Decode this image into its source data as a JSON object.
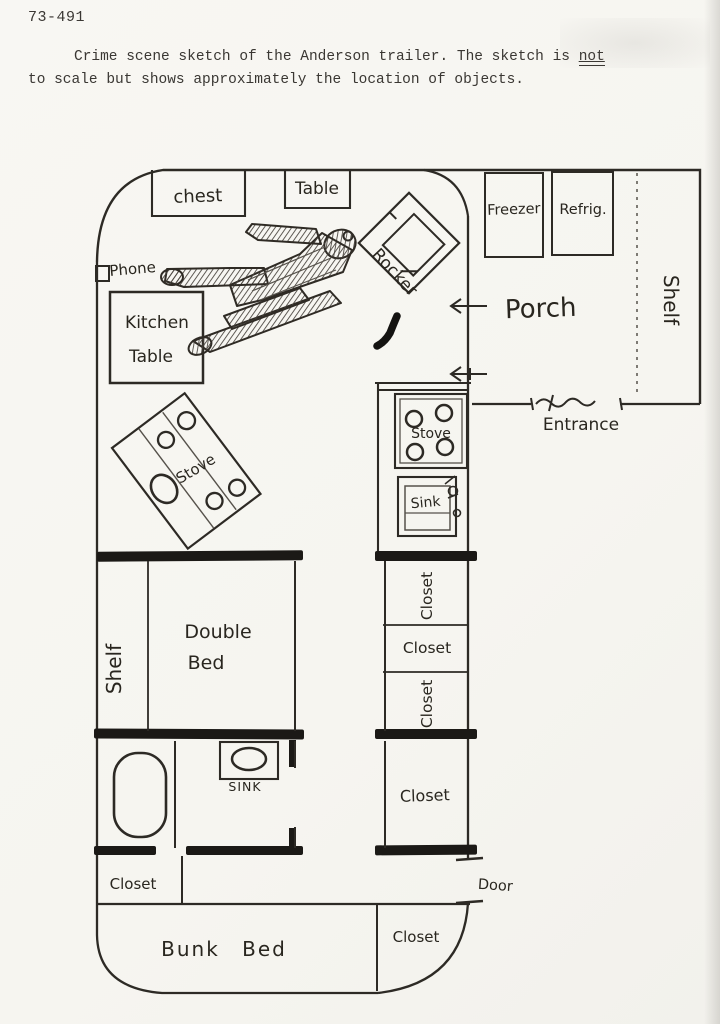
{
  "page": {
    "case_number": "73-491",
    "caption": {
      "prefix": "Crime scene sketch of the Anderson trailer. The sketch is ",
      "emphasized": "not",
      "line2": "to scale but shows approximately the location of objects."
    }
  },
  "floor_plan": {
    "rooms": {
      "porch": "Porch",
      "entrance": "Entrance",
      "door": "Door"
    },
    "furniture": {
      "chest": "chest",
      "table": "Table",
      "rocker": "Rocker",
      "phone": "Phone",
      "kitchen_table": [
        "Kitchen",
        "Table"
      ],
      "freezer": "Freezer",
      "refrigerator": "Refrig.",
      "porch_shelf": "Shelf",
      "stove_floor": "Stove",
      "stove_counter": "Stove",
      "sink_counter": "Sink",
      "closet_top": "Closet",
      "closet_middle": "Closet",
      "closet_lower": "Closet",
      "closet_large": "Closet",
      "bedroom_shelf": "Shelf",
      "double_bed": [
        "Double",
        "Bed"
      ],
      "bathroom_sink": "SINK",
      "closet_hall": "Closet",
      "bunk_bed": "Bunk Bed",
      "closet_bottom": "Closet"
    }
  }
}
